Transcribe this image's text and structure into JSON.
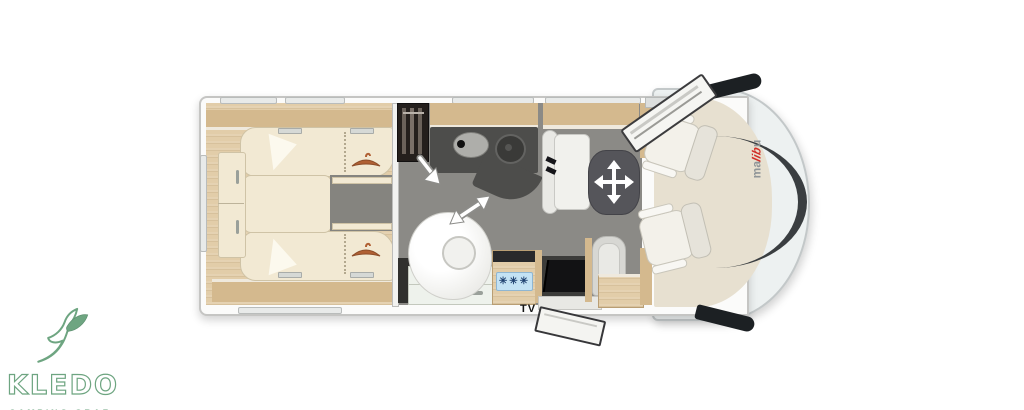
{
  "dealer_logo": {
    "name": "KLEDO",
    "subtitle": "CAMPING GRAZ",
    "color": "#6ea581",
    "icon": "dove-icon"
  },
  "vehicle_brand": {
    "full": "malibu",
    "prefix": "ma",
    "accent": "lib",
    "suffix": "u",
    "accent_color": "#d22d26",
    "letter_color": "#8f9598"
  },
  "floorplan": {
    "tv_label": "TV",
    "fridge_badge": "✳✳✳",
    "icons": {
      "dove": "dove-icon",
      "hanger": "hanger-icon",
      "snowflakes": "snowflake-badge",
      "table_move": "move-table-arrows-icon",
      "door_swing": "door-swing-arrow-icon"
    },
    "colors": {
      "floor": "#8b8a86",
      "wood": "#e2cda9",
      "bed": "#f2e9d3",
      "counter": "#4d4d4b",
      "table": "#55555a",
      "fridge_panel": "#c3e2f4",
      "snowflake": "#1d3f6e",
      "cab_body": "#edf1f1",
      "cab_floor": "#e7e0d0",
      "brand_red": "#d22d26",
      "logo_green": "#6ea581"
    }
  }
}
